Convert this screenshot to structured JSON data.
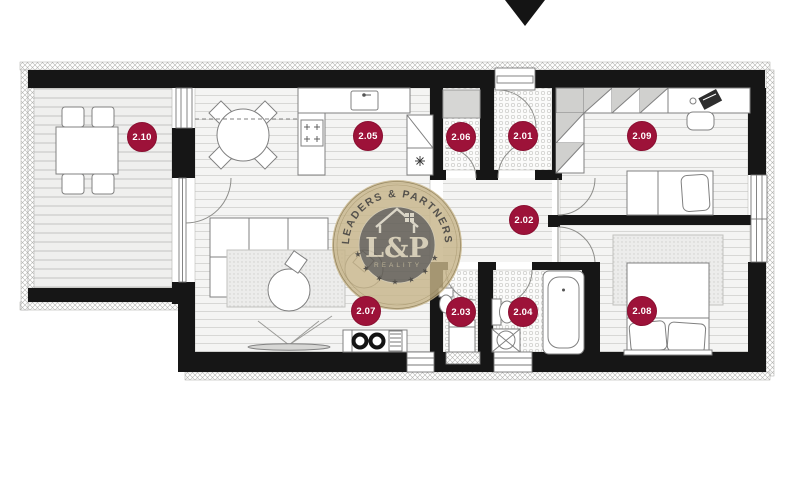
{
  "rooms": [
    {
      "label": "2.01"
    },
    {
      "label": "2.02"
    },
    {
      "label": "2.03"
    },
    {
      "label": "2.04"
    },
    {
      "label": "2.05"
    },
    {
      "label": "2.06"
    },
    {
      "label": "2.07"
    },
    {
      "label": "2.08"
    },
    {
      "label": "2.09"
    },
    {
      "label": "2.10"
    }
  ],
  "watermark": {
    "arc_text": "LEADERS & PARTNERS",
    "monogram": "L&P",
    "subtitle": "REALITY",
    "stars": "★ ★ ★ ★ ★ ★ ★"
  },
  "colors": {
    "badge": "#9d1239",
    "wall": "#161616",
    "logo_gold": "#c7b489",
    "logo_inner": "#5b5954"
  }
}
